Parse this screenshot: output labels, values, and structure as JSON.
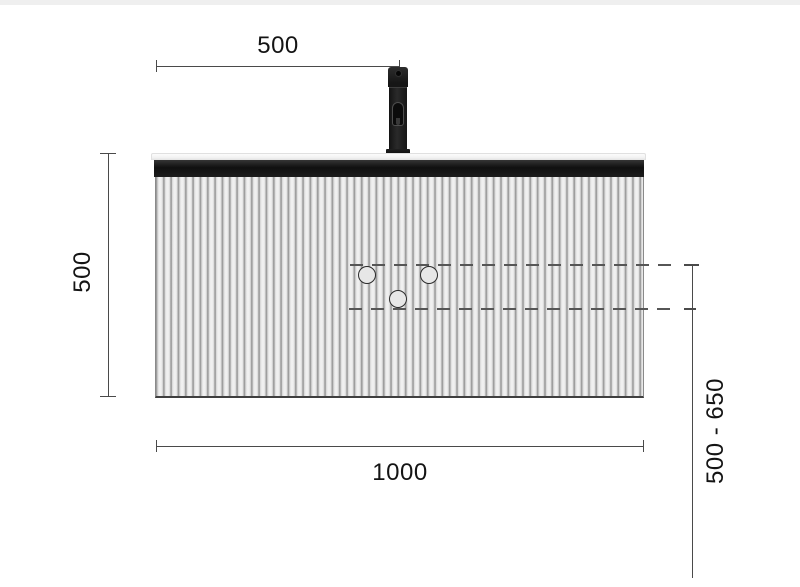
{
  "diagram": {
    "type": "technical-dimension-drawing",
    "subject": "wall-hung vanity cabinet with faucet, front elevation",
    "dimensions": {
      "faucet_offset": {
        "label": "500",
        "orientation": "horizontal",
        "position": "top"
      },
      "cabinet_height": {
        "label": "500",
        "orientation": "vertical",
        "position": "left"
      },
      "cabinet_width": {
        "label": "1000",
        "orientation": "horizontal",
        "position": "bottom"
      },
      "valve_mounting_height": {
        "label": "500 - 650",
        "orientation": "vertical",
        "position": "right"
      }
    },
    "valve_circles": {
      "count": 3
    },
    "reference_lines": {
      "style": "dashed",
      "count": 2
    },
    "colors": {
      "background": "#ffffff",
      "top_strip": "#efefef",
      "dimension_line": "#4a4a4a",
      "dimension_text": "#141414",
      "dashed_line": "#565656",
      "countertop": "#f3f3f3",
      "front_recess": "#1c1c1c",
      "flute_light": "#f1f1f1",
      "flute_dark": "#9e9e9e",
      "valve_fill": "#e7e7e7",
      "valve_stroke": "#2b2b2b",
      "faucet": "#1a1a1a"
    }
  }
}
